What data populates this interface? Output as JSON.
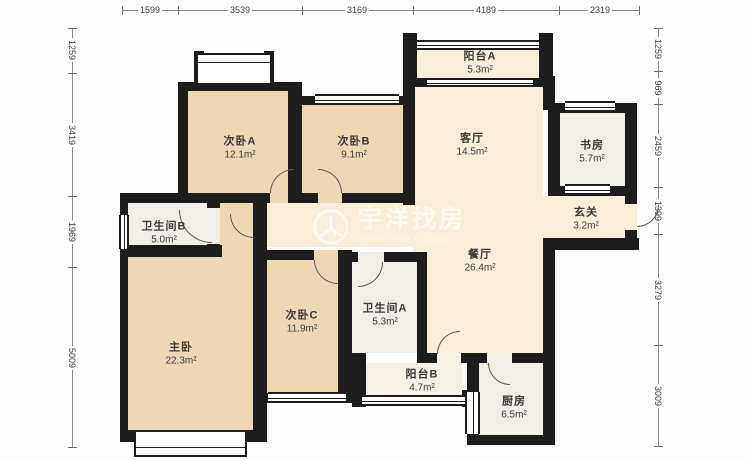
{
  "dims": {
    "top": [
      "1599",
      "3539",
      "3169",
      "4189",
      "2319"
    ],
    "left": [
      "1259",
      "3419",
      "1969",
      "5009"
    ],
    "right": [
      "1259",
      "969",
      "2459",
      "1399",
      "3279",
      "3009"
    ]
  },
  "rooms": {
    "bedroom_a": {
      "name": "次卧A",
      "area": "12.1m²"
    },
    "bedroom_b": {
      "name": "次卧B",
      "area": "9.1m²"
    },
    "balcony_a": {
      "name": "阳台A",
      "area": "5.3m²"
    },
    "living": {
      "name": "客厅",
      "area": "14.5m²"
    },
    "study": {
      "name": "书房",
      "area": "5.7m²"
    },
    "foyer": {
      "name": "玄关",
      "area": "3.2m²"
    },
    "bath_b": {
      "name": "卫生间B",
      "area": "5.0m²"
    },
    "dining": {
      "name": "餐厅",
      "area": "26.4m²"
    },
    "bedroom_c": {
      "name": "次卧C",
      "area": "11.9m²"
    },
    "bath_a": {
      "name": "卫生间A",
      "area": "5.3m²"
    },
    "master": {
      "name": "主卧",
      "area": "22.3m²"
    },
    "balcony_b": {
      "name": "阳台B",
      "area": "4.7m²"
    },
    "kitchen": {
      "name": "厨房",
      "area": "6.5m²"
    }
  },
  "watermark": {
    "brand": "宇洋找房",
    "url": "WWW.YYZF.COM"
  }
}
